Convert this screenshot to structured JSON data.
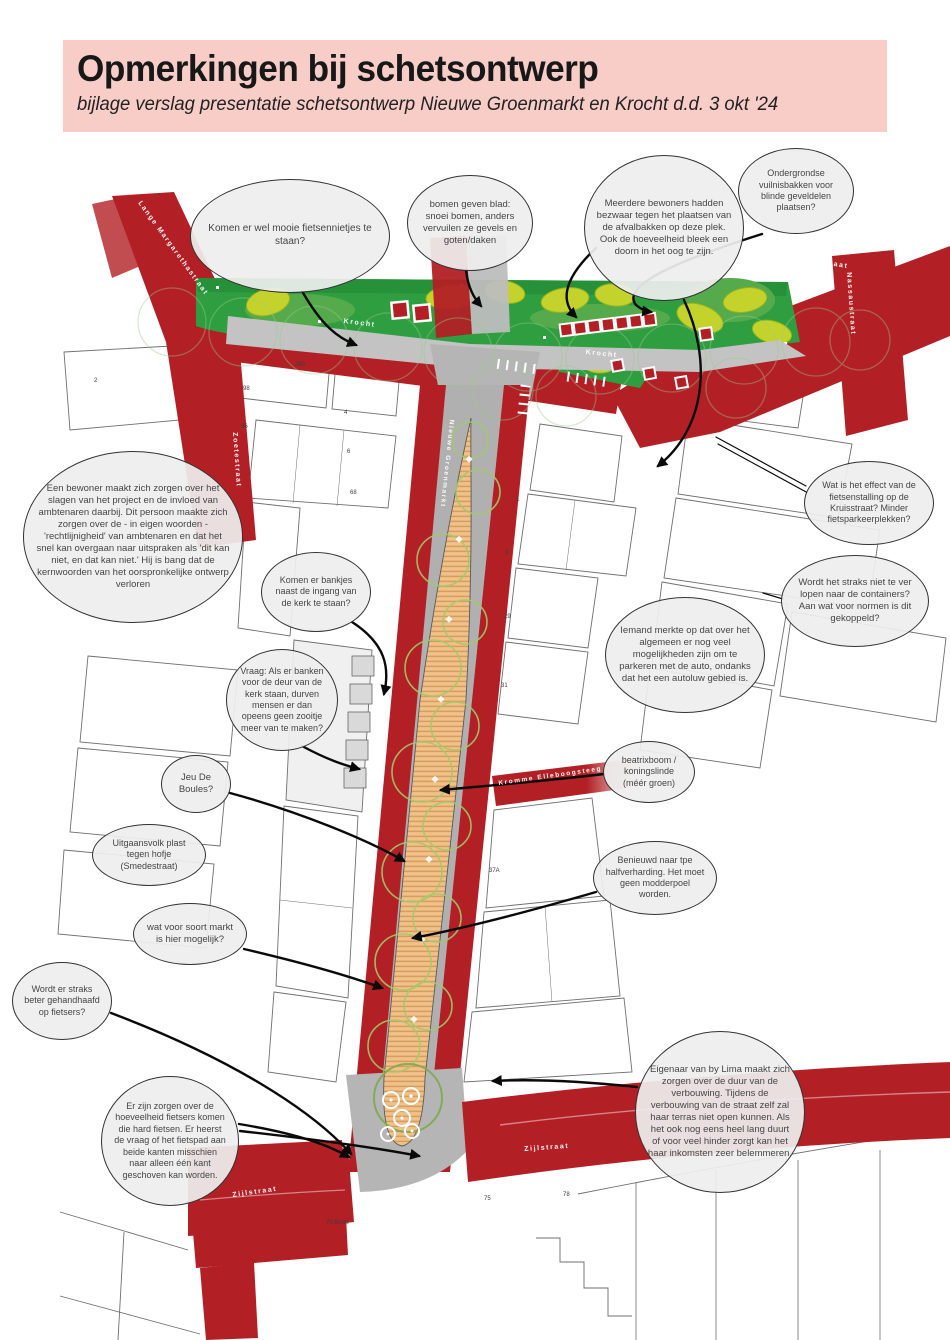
{
  "header": {
    "title": "Opmerkingen bij schetsontwerp",
    "subtitle": "bijlage verslag presentatie schetsontwerp Nieuwe Groenmarkt en Krocht d.d. 3 okt '24",
    "background": "#f8cdc7"
  },
  "map": {
    "colors": {
      "road_red": "#b22025",
      "park_green": "#2f9e41",
      "tree_yellow_green": "#c3d32c",
      "market_tan": "#f0c189",
      "path_gray": "#c3c3c3"
    },
    "street_labels": [
      {
        "text": "Lange Margarethastraat"
      },
      {
        "text": "Zoetestraat"
      },
      {
        "text": "Krocht"
      },
      {
        "text": "Krocht"
      },
      {
        "text": "Smedestraat"
      },
      {
        "text": "Nassaustraat"
      },
      {
        "text": "Nieuwe Groenmarkt"
      },
      {
        "text": "Kromme  Elleboogsteeg"
      },
      {
        "text": "Zijlstraat"
      },
      {
        "text": "Zijlstraat"
      }
    ],
    "parcel_numbers": [
      {
        "text": "2"
      },
      {
        "text": "280"
      },
      {
        "text": "98"
      },
      {
        "text": "96"
      },
      {
        "text": "4"
      },
      {
        "text": "6"
      },
      {
        "text": "68"
      },
      {
        "text": "1"
      },
      {
        "text": "3"
      },
      {
        "text": "29"
      },
      {
        "text": "31"
      },
      {
        "text": "37A"
      },
      {
        "text": "75"
      },
      {
        "text": "78"
      },
      {
        "text": "70 BVds"
      }
    ]
  },
  "bubbles": [
    {
      "text": "Komen er wel mooie fietsennietjes te staan?"
    },
    {
      "text": "bomen geven blad: snoei bomen, anders vervuilen ze gevels en goten/daken"
    },
    {
      "text": "Meerdere bewoners hadden bezwaar tegen het plaatsen van de afvalbakken op deze plek. Ook de hoeveelheid bleek een doorn in het oog te zijn."
    },
    {
      "text": "Ondergrondse vuilnisbakken voor blinde geveldelen plaatsen?"
    },
    {
      "text": "Een bewoner maakt zich zorgen over het slagen van het project en de invloed van ambtenaren daarbij. Dit persoon maakte zich zorgen over de - in eigen woorden - 'rechtlijnigheid' van ambtenaren en dat het snel kan overgaan naar uitspraken als 'dit kan niet, en dat kan niet.' Hij is bang dat de kernwoorden van het oorspronkelijke ontwerp verloren"
    },
    {
      "text": "Wat is het effect van de fietsenstalling op de Kruisstraat? Minder fietsparkeerplekken?"
    },
    {
      "text": "Wordt het straks niet te ver lopen naar de containers? Aan wat voor normen is dit gekoppeld?"
    },
    {
      "text": "Komen er bankjes naast de ingang van de kerk te staan?"
    },
    {
      "text": "Iemand merkte op dat over het algemeen er nog veel mogelijkheden zijn om te parkeren met de auto, ondanks dat het een autoluw gebied is."
    },
    {
      "text": "Vraag: Als er banken voor de deur van de kerk staan, durven mensen er dan opeens geen zooitje meer van te maken?"
    },
    {
      "text": "Jeu De Boules?"
    },
    {
      "text": "beatrixboom / koningslinde (méér groen)"
    },
    {
      "text": "Uitgaansvolk plast tegen hofje (Smedestraat)"
    },
    {
      "text": "Benieuwd naar tpe halfverharding. Het moet geen modderpoel worden."
    },
    {
      "text": "wat voor soort markt is hier mogelijk?"
    },
    {
      "text": "Wordt er straks beter gehandhaafd op fietsers?"
    },
    {
      "text": "Er zijn zorgen over de hoeveelheid fietsers komen die hard fietsen. Er heerst de vraag of het fietspad aan beide kanten misschien naar alleen één kant geschoven kan worden."
    },
    {
      "text": "Eigenaar van by Lima maakt zich zorgen over de duur van de verbouwing. Tijdens de verbouwing van de straat zelf zal haar terras niet open kunnen. Als het ook nog eens heel lang duurt of voor veel hinder zorgt kan het haar inkomsten zeer belemmeren."
    }
  ]
}
